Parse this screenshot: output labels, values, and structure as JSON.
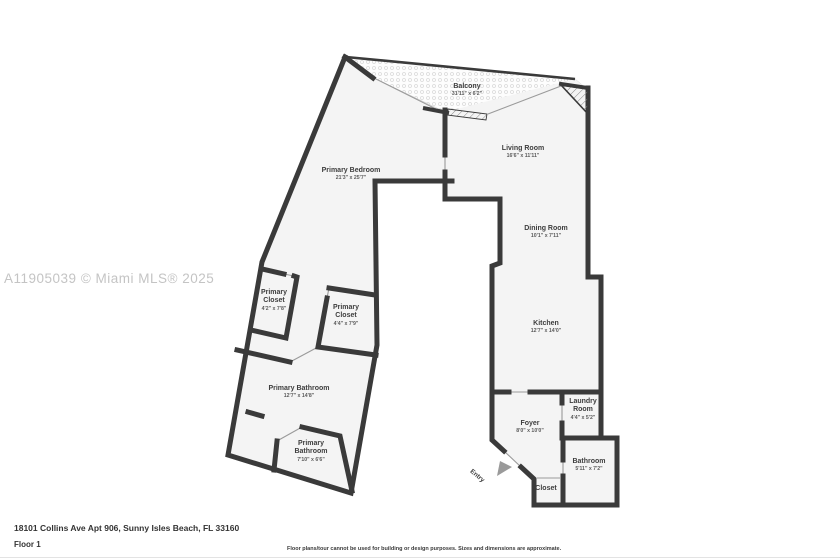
{
  "watermark": "A11905039 © Miami MLS® 2025",
  "entry": {
    "label": "Entry"
  },
  "footer": {
    "address": "18101 Collins Ave Apt 906, Sunny Isles Beach, FL 33160",
    "floor": "Floor 1",
    "disclaimer": "Floor plans/tour cannot be used for building or design purposes. Sizes and dimensions are approximate."
  },
  "colors": {
    "wall": "#3a3a3a",
    "floor": "#f4f4f4",
    "thin_line": "#9a9a9a",
    "balcony_dot": "#d9d9d9",
    "watermark": "#c4c4c4",
    "label": "#3d3d3d"
  },
  "rooms": [
    {
      "name": "Balcony",
      "dims": "31'11\" x 6'2\""
    },
    {
      "name": "Living Room",
      "dims": "16'6\" x 11'11\""
    },
    {
      "name": "Primary Bedroom",
      "dims": "21'3\" x 25'7\""
    },
    {
      "name": "Dining Room",
      "dims": "10'1\" x 7'11\""
    },
    {
      "name": "Kitchen",
      "dims": "12'7\" x 14'0\""
    },
    {
      "name": "Primary Closet",
      "dims": "4'2\" x 7'8\""
    },
    {
      "name": "Primary Closet",
      "dims": "4'4\" x 7'9\""
    },
    {
      "name": "Primary Bathroom",
      "dims": "12'7\" x 14'8\""
    },
    {
      "name": "Primary Bathroom",
      "dims": "7'10\" x 6'6\""
    },
    {
      "name": "Foyer",
      "dims": "8'0\" x 10'0\""
    },
    {
      "name": "Laundry Room",
      "dims": "4'4\" x 5'2\""
    },
    {
      "name": "Bathroom",
      "dims": "5'11\" x 7'2\""
    },
    {
      "name": "Closet",
      "dims": ""
    }
  ]
}
